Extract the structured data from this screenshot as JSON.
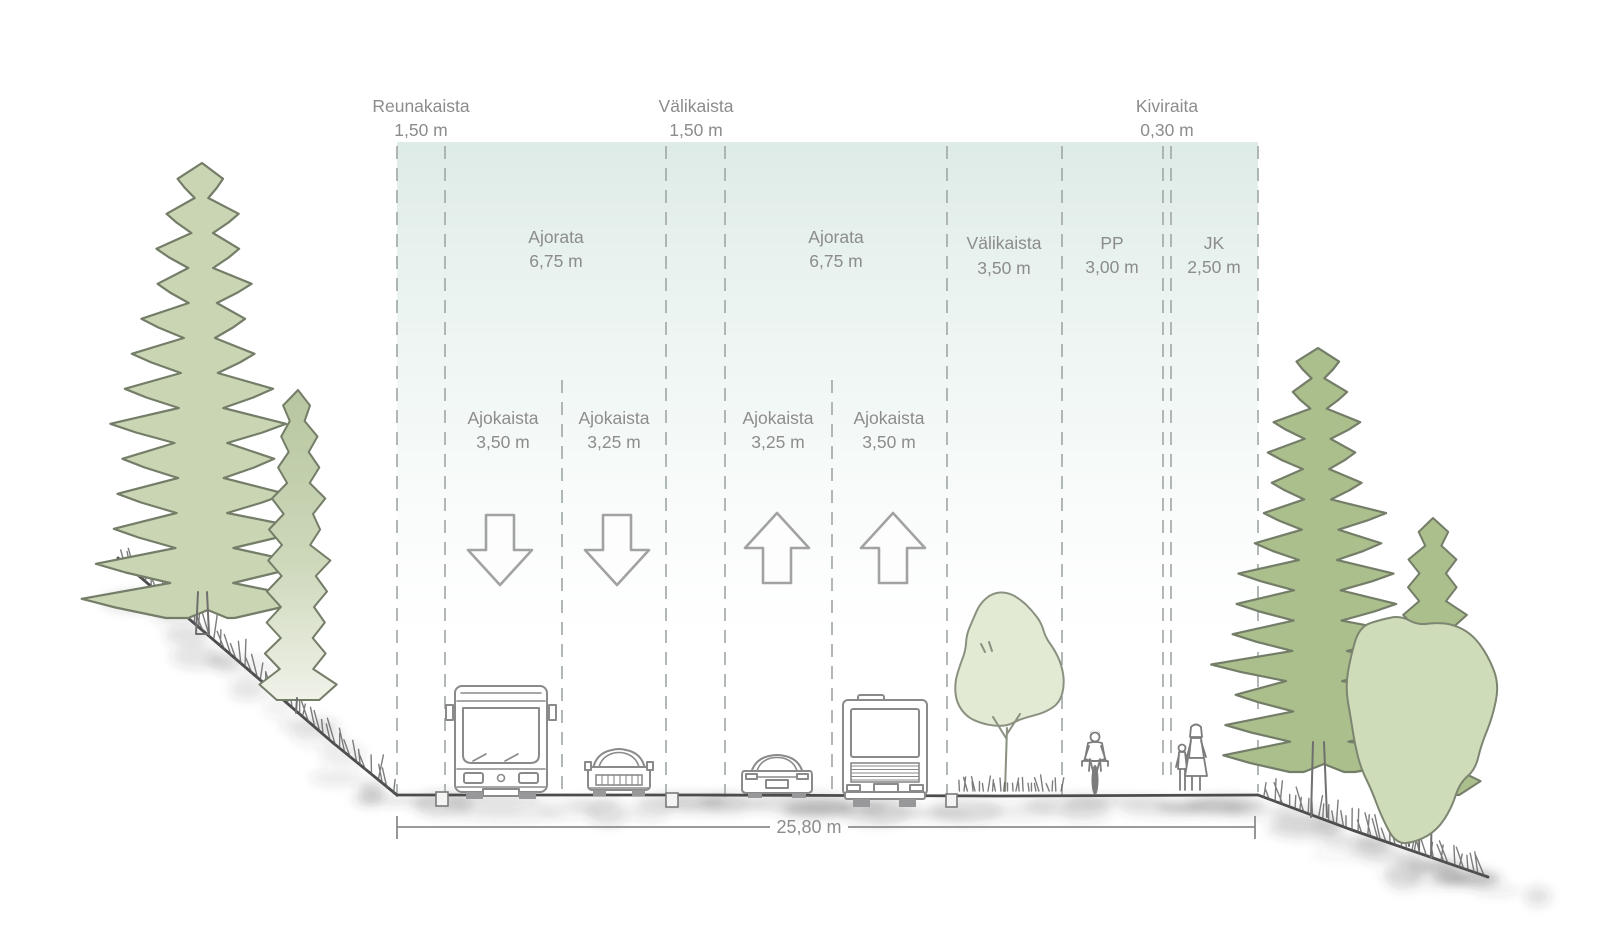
{
  "cross_section": {
    "top_labels": [
      {
        "name": "Reunakaista",
        "width": "1,50 m"
      },
      {
        "name": "Välikaista",
        "width": "1,50 m"
      },
      {
        "name": "Kiviraita",
        "width": "0,30 m"
      }
    ],
    "zones": [
      {
        "name": "Ajorata",
        "width": "6,75 m"
      },
      {
        "name": "Ajorata",
        "width": "6,75 m"
      },
      {
        "name": "Välikaista",
        "width": "3,50 m"
      },
      {
        "name": "PP",
        "width": "3,00 m"
      },
      {
        "name": "JK",
        "width": "2,50 m"
      }
    ],
    "lanes": [
      {
        "name": "Ajokaista",
        "width": "3,50 m",
        "direction": "down"
      },
      {
        "name": "Ajokaista",
        "width": "3,25 m",
        "direction": "down"
      },
      {
        "name": "Ajokaista",
        "width": "3,25 m",
        "direction": "up"
      },
      {
        "name": "Ajokaista",
        "width": "3,50 m",
        "direction": "up"
      }
    ],
    "total_width": "25,80 m"
  },
  "scene": {
    "left_vegetation": [
      "spruce",
      "cypress"
    ],
    "median_tree": "deciduous tree",
    "right_vegetation": [
      "spruce",
      "conifer",
      "deciduous tree"
    ],
    "vehicles": [
      "bus front",
      "car front",
      "sports car rear",
      "bus rear"
    ],
    "people": [
      "cyclist",
      "adult pedestrian",
      "child pedestrian"
    ]
  },
  "colors": {
    "sky_wash": "#dfeee9",
    "label_gray": "#8c8c8c",
    "dash_gray": "#a4aca8",
    "outline_gray": "#8a8a8a",
    "tree_light": "#c9d5b3",
    "tree_medium": "#abbf8d",
    "tree_pale": "#e3ead4",
    "tree_soft": "#cfdcba",
    "tree_outline": "#747d68"
  }
}
